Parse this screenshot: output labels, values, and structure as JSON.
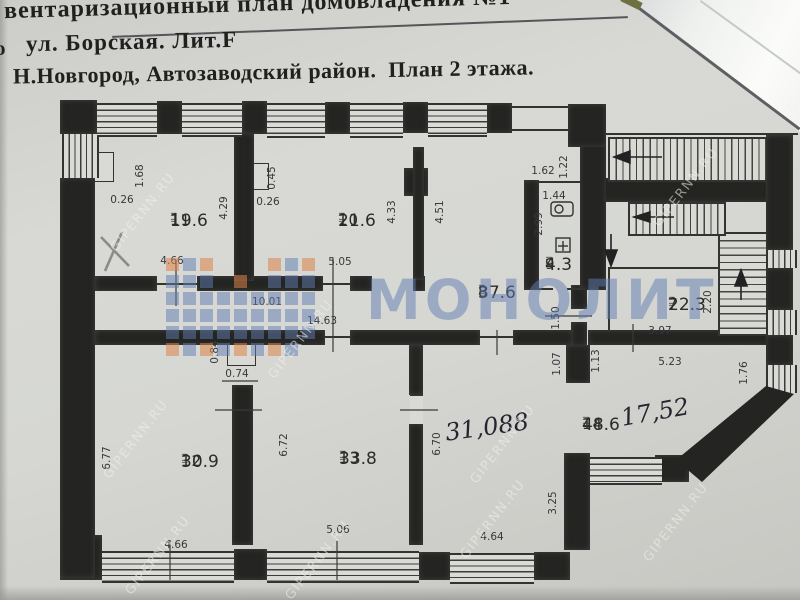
{
  "header": {
    "line1": "вентаризационный план домовладения №1",
    "line2": "ул. Борская. Лит.F",
    "line3": "Н.Новгород, Автозаводский район.  План 2 этажа.",
    "edge_fragment": "о"
  },
  "watermarks": {
    "site": "GIPERNN.RU",
    "brand": "МОНОЛИТ",
    "brand_blue": "rgba(96,124,178,0.5)",
    "brand_orange": "rgba(221,133,72,0.55)"
  },
  "plan": {
    "area_marks": "= =",
    "rooms": [
      {
        "number": "11",
        "area": "19.6",
        "x": 170,
        "y": 212
      },
      {
        "number": "10",
        "area": "21.6",
        "x": 338,
        "y": 212
      },
      {
        "number": "8",
        "area": "37.6",
        "x": 478,
        "y": 284
      },
      {
        "number": "9",
        "area": "4.3",
        "x": 545,
        "y": 256
      },
      {
        "number": "7",
        "area": "22.3",
        "x": 668,
        "y": 296
      },
      {
        "number": "12",
        "area": "30.9",
        "x": 181,
        "y": 453
      },
      {
        "number": "13",
        "area": "33.8",
        "x": 339,
        "y": 450
      },
      {
        "number": "14",
        "area": "48.6",
        "x": 582,
        "y": 416
      }
    ],
    "handwritten": [
      {
        "text": "31,088",
        "x": 487,
        "y": 427,
        "rot": -8
      },
      {
        "text": "17,52",
        "x": 655,
        "y": 412,
        "rot": -10
      }
    ],
    "dimensions": [
      {
        "v": "1.68",
        "x": 140,
        "y": 176,
        "rot": -90
      },
      {
        "v": "0.26",
        "x": 122,
        "y": 200,
        "rot": 0
      },
      {
        "v": "4.66",
        "x": 172,
        "y": 261,
        "rot": 0
      },
      {
        "v": "4.29",
        "x": 224,
        "y": 208,
        "rot": -90
      },
      {
        "v": "0.45",
        "x": 272,
        "y": 178,
        "rot": -90
      },
      {
        "v": "0.26",
        "x": 268,
        "y": 202,
        "rot": 0
      },
      {
        "v": "5.05",
        "x": 340,
        "y": 262,
        "rot": 0
      },
      {
        "v": "4.33",
        "x": 392,
        "y": 212,
        "rot": -90
      },
      {
        "v": "4.51",
        "x": 440,
        "y": 212,
        "rot": -90
      },
      {
        "v": "10.01",
        "x": 267,
        "y": 302,
        "rot": 0
      },
      {
        "v": "14.63",
        "x": 322,
        "y": 321,
        "rot": 0
      },
      {
        "v": "0.84",
        "x": 215,
        "y": 352,
        "rot": -90
      },
      {
        "v": "0.74",
        "x": 237,
        "y": 374,
        "rot": 0
      },
      {
        "v": "6.77",
        "x": 107,
        "y": 458,
        "rot": -90
      },
      {
        "v": "4.66",
        "x": 176,
        "y": 545,
        "rot": 0
      },
      {
        "v": "6.72",
        "x": 284,
        "y": 445,
        "rot": -90
      },
      {
        "v": "5.06",
        "x": 338,
        "y": 530,
        "rot": 0
      },
      {
        "v": "6.70",
        "x": 437,
        "y": 444,
        "rot": -90
      },
      {
        "v": "4.64",
        "x": 492,
        "y": 537,
        "rot": 0
      },
      {
        "v": "3.25",
        "x": 553,
        "y": 503,
        "rot": -90
      },
      {
        "v": "1.62",
        "x": 543,
        "y": 171,
        "rot": 0
      },
      {
        "v": "1.22",
        "x": 564,
        "y": 167,
        "rot": -90
      },
      {
        "v": "1.44",
        "x": 554,
        "y": 196,
        "rot": 0
      },
      {
        "v": "2.99",
        "x": 539,
        "y": 224,
        "rot": -90
      },
      {
        "v": "1.50",
        "x": 556,
        "y": 318,
        "rot": -90
      },
      {
        "v": "1.07",
        "x": 557,
        "y": 364,
        "rot": -90
      },
      {
        "v": "1.13",
        "x": 596,
        "y": 361,
        "rot": -90
      },
      {
        "v": "3.97",
        "x": 660,
        "y": 331,
        "rot": 0
      },
      {
        "v": "5.23",
        "x": 670,
        "y": 362,
        "rot": 0
      },
      {
        "v": "2.20",
        "x": 708,
        "y": 302,
        "rot": -90
      },
      {
        "v": "1.76",
        "x": 744,
        "y": 373,
        "rot": -90
      }
    ]
  }
}
